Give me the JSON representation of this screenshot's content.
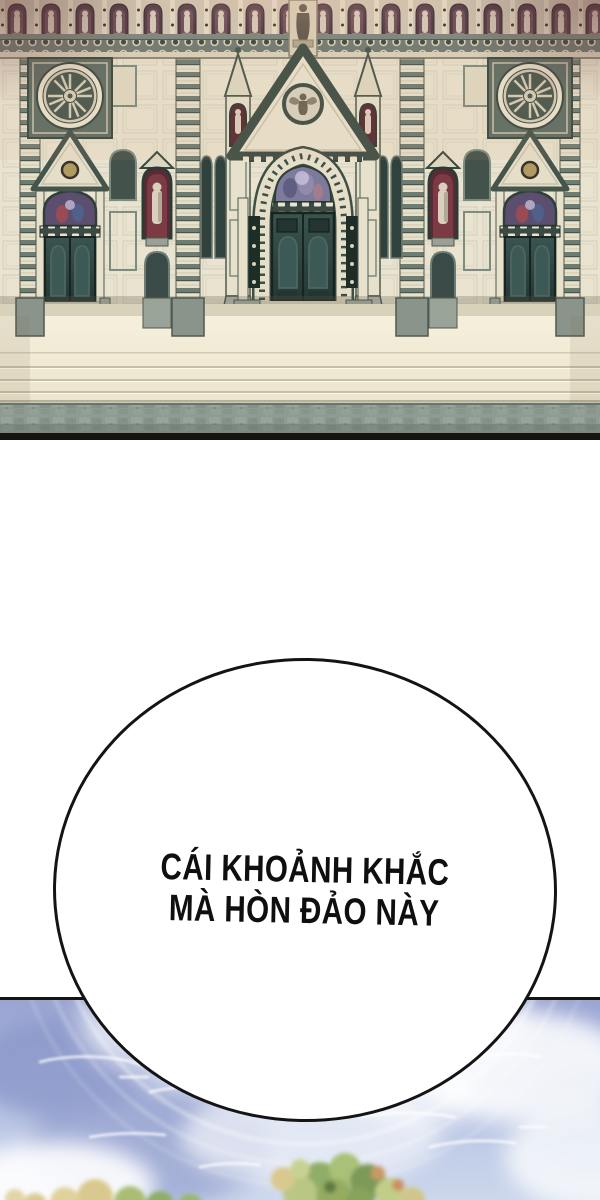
{
  "page": {
    "background": "#ffffff"
  },
  "cathedral": {
    "name": "gothic cathedral facade",
    "colors": {
      "stone_cream": "#e9e3cf",
      "trim_green": "#3f4f46",
      "door_teal": "#2e4441",
      "niche_maroon": "#5c2a34",
      "steps_cream": "#f1ebd6",
      "pavement_gray": "#8e9b93",
      "glow_pink": "#f3bd9e",
      "border_black": "#15150f"
    }
  },
  "speech_bubble": {
    "line1": "CÁI KHOẢNH KHẮC",
    "line2": "MÀ HÒN ĐẢO NÀY",
    "fill": "#ffffff",
    "border": "#141414",
    "text_color": "#0f0f0f"
  },
  "sky": {
    "name": "sky over island treetops",
    "colors": {
      "sky_deep": "#9aa5d3",
      "sky_light": "#ccd7ec",
      "cloud_white": "#ffffff",
      "foliage_green": "#8fae68",
      "foliage_tan": "#d9c98e",
      "border_black": "#15150f"
    }
  }
}
